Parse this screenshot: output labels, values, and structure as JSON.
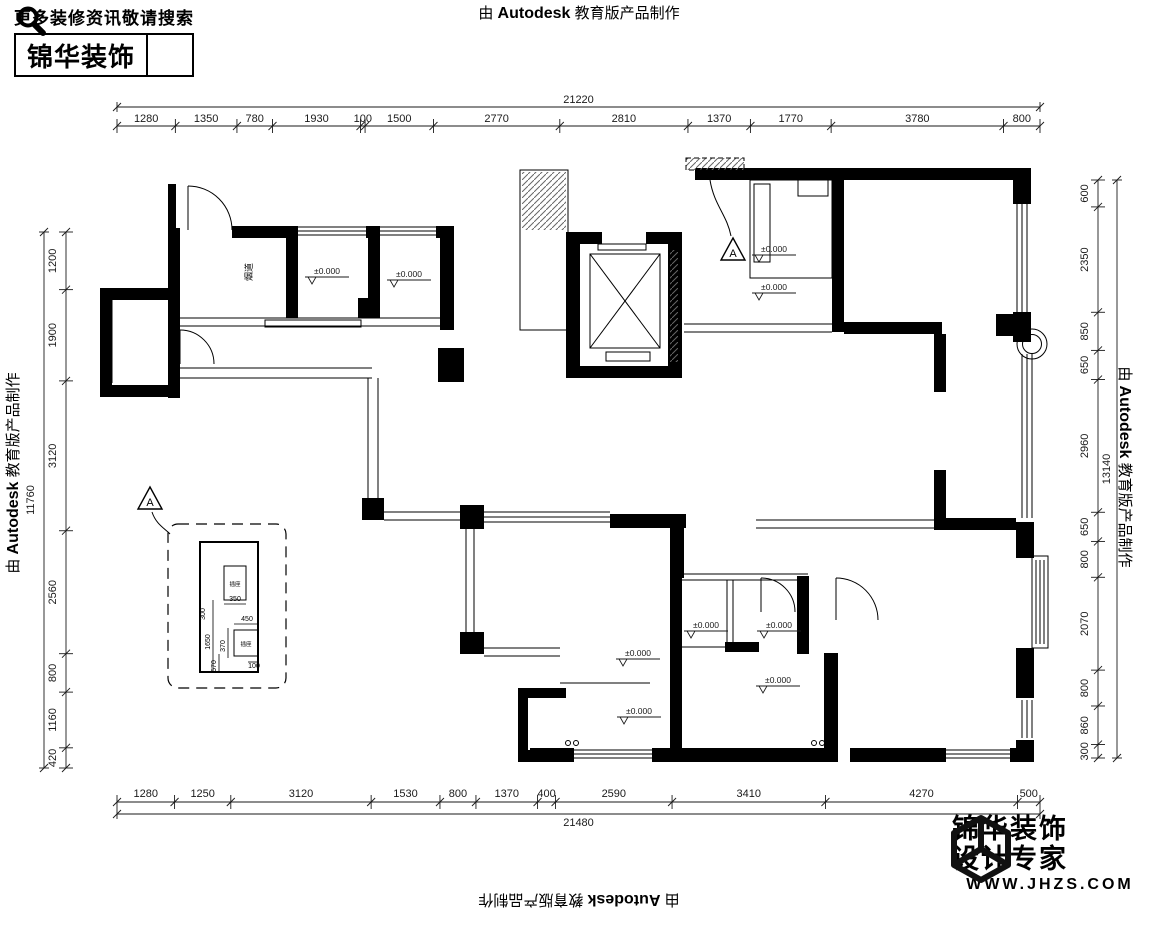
{
  "watermark": {
    "prefix": "由",
    "brand": "Autodesk",
    "suffix": "教育版产品制作"
  },
  "branding": {
    "top_left": {
      "tagline": "更多装修资讯敬请搜索",
      "brand": "锦华装饰"
    },
    "bottom_right": {
      "line1": "锦华装饰",
      "line2": "设计专家",
      "website": "WWW.JHZS.COM"
    }
  },
  "dimensions": {
    "top": {
      "total": "21220",
      "segments": [
        1280,
        1350,
        780,
        1930,
        100,
        1500,
        2770,
        2810,
        1370,
        1770,
        3780,
        800
      ]
    },
    "bottom": {
      "total": "21480",
      "segments": [
        1280,
        1250,
        3120,
        1530,
        800,
        1370,
        400,
        2590,
        3410,
        4270,
        500
      ]
    },
    "left": {
      "total": "11760",
      "segments": [
        1200,
        1900,
        3120,
        2560,
        800,
        1160,
        420
      ]
    },
    "right": {
      "total": "13140",
      "segments": [
        600,
        2350,
        850,
        650,
        2960,
        650,
        800,
        2070,
        800,
        860,
        300
      ]
    }
  },
  "plan": {
    "level_label": "±0.000",
    "level_marks": [
      {
        "x": 325,
        "y": 274
      },
      {
        "x": 407,
        "y": 277
      },
      {
        "x": 772,
        "y": 252
      },
      {
        "x": 772,
        "y": 290
      },
      {
        "x": 704,
        "y": 628
      },
      {
        "x": 777,
        "y": 628
      },
      {
        "x": 636,
        "y": 656
      },
      {
        "x": 776,
        "y": 683
      },
      {
        "x": 637,
        "y": 714
      }
    ],
    "flue_label": "烟道",
    "detail_marker_label": "A",
    "detail": {
      "box_labels": [
        "插座",
        "插座"
      ],
      "dims": [
        "350",
        "300",
        "1650",
        "450",
        "370",
        "570",
        "100"
      ]
    }
  }
}
